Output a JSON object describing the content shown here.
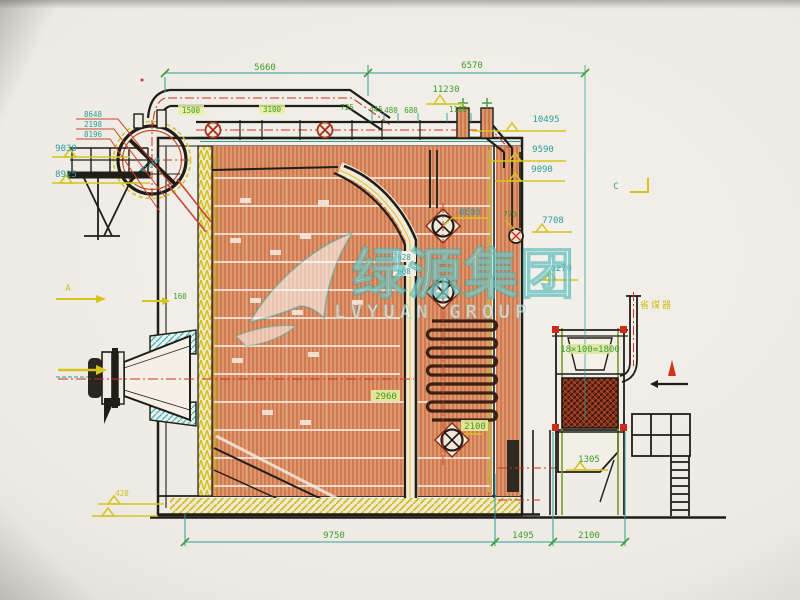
{
  "watermark": {
    "cn": "绿源集团",
    "en": "LVYUAN GROUP",
    "color": "#2fa8a4"
  },
  "markers": {
    "a": "A",
    "c": "C"
  },
  "labels": {
    "top_dim_left": "5660",
    "top_dim_right": "6570",
    "elev_11230": "11230",
    "pipe_dim_1": "1500",
    "pipe_dim_2": "3100",
    "pipe_dim_3": "725",
    "nozzle_dim_1": "445",
    "nozzle_dim_2": "480",
    "nozzle_dim_3": "680",
    "nozzle_dim_4": "1180",
    "elev_10495": "10495",
    "elev_9590": "9590",
    "elev_9090": "9090",
    "elev_9030": "9030",
    "elev_8925": "8925",
    "pipe_tag_1": "8648",
    "pipe_tag_2": "2198",
    "pipe_tag_3": "8196",
    "drum_tag": "Φ1600",
    "elev_8603": "8603",
    "dim_770": "770",
    "elev_7708": "7708",
    "elev_6270": "6270",
    "tag_628": "628",
    "tag_608": "608",
    "wall_tag": "160",
    "dim_2960": "2960",
    "dim_2100_mid": "2100",
    "eco_pitch": "18×100=1800",
    "elev_1305": "1305",
    "elev_420": "420",
    "bottom_dim_1": "9750",
    "bottom_dim_2": "1495",
    "bottom_dim_3": "2100",
    "note_economizer": "省煤器"
  },
  "palette": {
    "paper": "#efece5",
    "line": "#211d17",
    "hatch_red": "#c2512b",
    "dim_green": "#3f9d28",
    "dim_cyan": "#2a9d9d",
    "elev_yellow": "#d6c41c",
    "centerline_red": "#cc3322",
    "coil_dark": "#3a2113",
    "watermark_teal": "#2fa8a4"
  }
}
